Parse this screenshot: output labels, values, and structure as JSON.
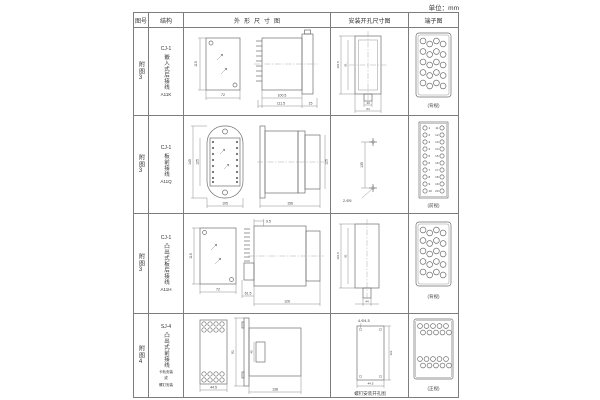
{
  "unit_label": "单位：mm",
  "table": {
    "headers": [
      "图号",
      "结构",
      "外形尺寸图",
      "安装开孔尺寸图",
      "端子图"
    ],
    "rows": [
      {
        "fig_no": "附图3",
        "model": "CJ-1",
        "name": "嵌入式后接线",
        "code": "A11K",
        "outline": {
          "front_height": "115",
          "front_width": "72",
          "body_depth": "100.5",
          "total_depth": "111.5",
          "flange_depth": "15"
        },
        "mounting": {
          "cutout_height": "101.5",
          "inner_height": "91",
          "slot_width": "14",
          "cutout_width": "64"
        },
        "terminal": {
          "caption": "(背视)"
        }
      },
      {
        "fig_no": "附图3",
        "model": "CJ-1",
        "name": "板前接线",
        "code": "A11Q",
        "outline": {
          "flange_height": "145",
          "body_height": "125",
          "flange_width": "105",
          "depth": "156",
          "side_height": "125"
        },
        "mounting": {
          "hole_spacing": "135",
          "holes": "2-Φ5"
        },
        "terminal": {
          "caption": "(前视)",
          "left_numbers": [
            "1",
            "2",
            "3",
            "4",
            "5",
            "6",
            "7",
            "8",
            "9",
            "10"
          ],
          "right_numbers": [
            "11",
            "12",
            "13",
            "14",
            "15",
            "16",
            "17",
            "18",
            "19",
            "20"
          ]
        }
      },
      {
        "fig_no": "附图3",
        "model": "CJ-1",
        "name": "凸出式板后接线",
        "code": "A11H",
        "outline": {
          "front_height": "115",
          "front_width": "72",
          "rear_depth": "61.5",
          "tip_depth": "9.5",
          "body_depth": "126"
        },
        "mounting": {
          "cutout_height": "101.5",
          "inner_height": "91",
          "cutout_width": "44"
        },
        "terminal": {
          "caption": "(背视)"
        }
      },
      {
        "fig_no": "附图4",
        "model": "SJ-4",
        "name": "凸出式前接线",
        "notes": [
          "卡轨安装",
          "或",
          "螺钉安装"
        ],
        "outline": {
          "front_width": "44.5",
          "side_height": "91",
          "bracket_height": "45",
          "depth": "138"
        },
        "mounting": {
          "holes": "4-Φ4.5",
          "hole_height": "121",
          "hole_width": "44.5",
          "caption": "螺钉安装开孔图"
        },
        "terminal": {
          "caption": "(正视)"
        }
      }
    ]
  }
}
